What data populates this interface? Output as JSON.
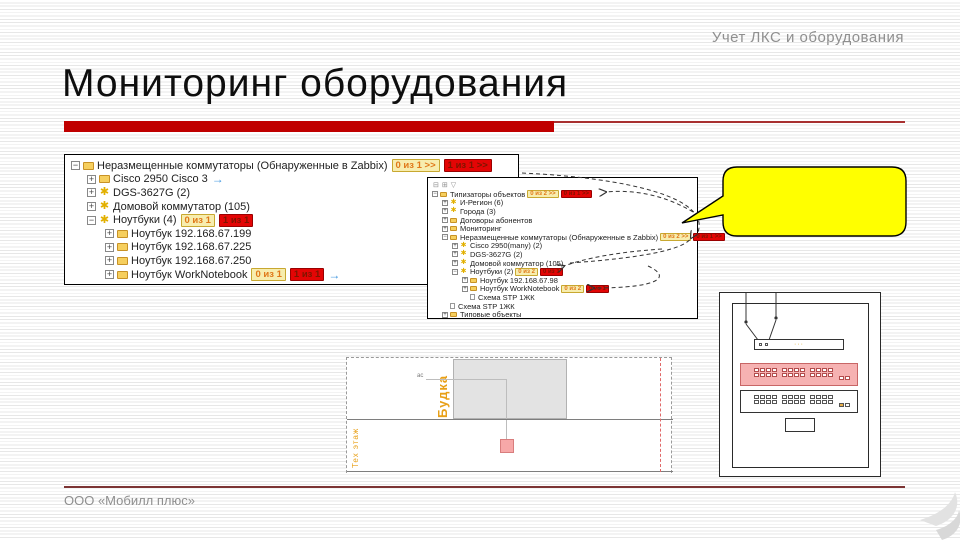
{
  "slide": {
    "header": "Учет ЛКС и оборудования",
    "title": "Мониторинг оборудования",
    "footer": "ООО «Мобилл плюс»",
    "accent_color": "#c00000",
    "callout_color": "#ffff00"
  },
  "tree1": {
    "rows": [
      {
        "label": "Неразмещенные коммутаторы (Обнаруженные в Zabbix)",
        "badge_yellow": "0 из 1 >>",
        "badge_red": "1 из 1 >>"
      },
      {
        "label": "Cisco 2950 Cisco 3"
      },
      {
        "label": "DGS-3627G (2)"
      },
      {
        "label": "Домовой коммутатор (105)"
      },
      {
        "label": "Ноутбуки (4)",
        "badge_yellow": "0 из 1",
        "badge_red": "1 из 1"
      },
      {
        "label": "Ноутбук 192.168.67.199"
      },
      {
        "label": "Ноутбук 192.168.67.225"
      },
      {
        "label": "Ноутбук 192.168.67.250"
      },
      {
        "label": "Ноутбук WorkNotebook",
        "badge_yellow": "0 из 1",
        "badge_red": "1 из 1"
      }
    ]
  },
  "tree2": {
    "toolbar": [
      {
        "name": "collapse-all-icon",
        "glyph": "⊟"
      },
      {
        "name": "expand-all-icon",
        "glyph": "⊞"
      },
      {
        "name": "filter-icon",
        "glyph": "▽"
      }
    ],
    "rows": [
      {
        "label": "Типизаторы объектов",
        "badge_yellow": "0 из 2 >>",
        "badge_red": "0 из 1 >>"
      },
      {
        "label": "И-Регион (6)"
      },
      {
        "label": "Города (3)"
      },
      {
        "label": "Договоры абонентов"
      },
      {
        "label": "Мониторинг"
      },
      {
        "label": "Неразмещенные коммутаторы (Обнаруженные в Zabbix)",
        "badge_yellow": "0 из 2 >>",
        "badge_red": "0 из 1 >>"
      },
      {
        "label": "Cisco 2950(many) (2)"
      },
      {
        "label": "DGS-3627G (2)"
      },
      {
        "label": "Домовой коммутатор (105)"
      },
      {
        "label": "Ноутбуки (2)",
        "badge_yellow": "0 из 2",
        "badge_red": "0 из 1"
      },
      {
        "label": "Ноутбук 192.168.67.98"
      },
      {
        "label": "Ноутбук WorkNotebook",
        "badge_yellow": "0 из 2",
        "badge_red": "0 из 1"
      },
      {
        "label": "Схема STP 1ЖК"
      },
      {
        "label": "Схема STP 1ЖК"
      },
      {
        "label": "Типовые объекты"
      }
    ]
  },
  "plan": {
    "room_label": "Будка",
    "floor_label": "Тех этаж",
    "point_label": "ас"
  },
  "rack": {
    "panel_label": "···"
  }
}
